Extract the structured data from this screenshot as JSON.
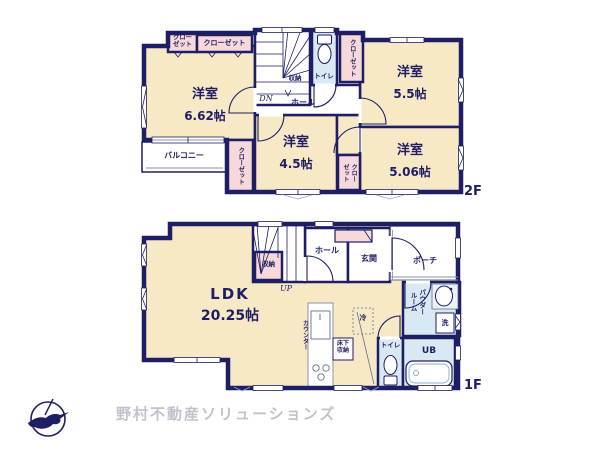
{
  "colors": {
    "wall": "#1e1e64",
    "room_fill": "#f7e9c6",
    "closet_fill": "#f8d9da",
    "wet_fill": "#d9e9f3",
    "logo_text": "#c2c2cc"
  },
  "floor2": {
    "label": "2F",
    "rooms": {
      "room_662": {
        "name": "洋室",
        "size": "6.62帖"
      },
      "room_55": {
        "name": "洋室",
        "size": "5.5帖"
      },
      "room_45": {
        "name": "洋室",
        "size": "4.5帖"
      },
      "room_506": {
        "name": "洋室",
        "size": "5.06帖"
      }
    },
    "labels": {
      "closet_a": "クローゼット",
      "closet_b": "クローゼット",
      "closet_c": "クローゼット",
      "closet_d": "クローゼット",
      "closet_e": "クローゼット",
      "balcony": "バルコニー",
      "hall": "ホール",
      "toilet": "トイレ",
      "storage": "収納",
      "stairs_dn": "DN"
    }
  },
  "floor1": {
    "label": "1F",
    "rooms": {
      "ldk": {
        "name": "LDK",
        "size": "20.25帖"
      }
    },
    "labels": {
      "storage": "収納",
      "stairs_up": "UP",
      "hall": "ホール",
      "entrance": "玄関",
      "porch": "ポーチ",
      "powder_room": "パウダールーム",
      "washer": "洗",
      "toilet": "トイレ",
      "unit_bath": "UB",
      "fridge": "冷",
      "underfloor_storage": "床下収納",
      "counter": "カウンター"
    }
  },
  "footer": {
    "company": "野村不動産ソリューションズ"
  }
}
